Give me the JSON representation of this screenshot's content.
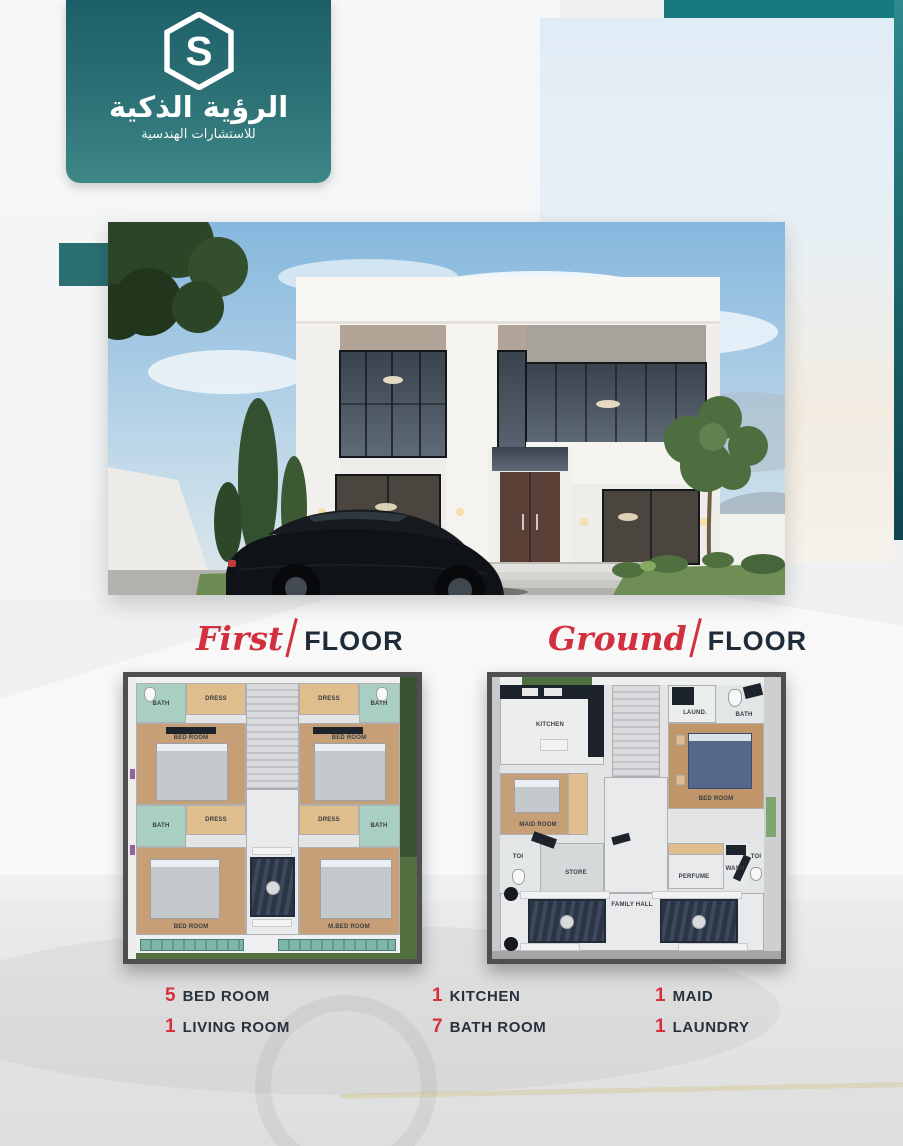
{
  "brand": {
    "title_ar": "الرؤية الذكية",
    "subtitle_ar": "للاستشارات الهندسية",
    "logo_letter": "S"
  },
  "sections": {
    "first": {
      "script": "First",
      "word": "FLOOR"
    },
    "ground": {
      "script": "Ground",
      "word": "FLOOR"
    }
  },
  "plans": {
    "first": {
      "rooms": [
        "DRESS",
        "BATH",
        "BED ROOM",
        "DRESS",
        "BATH",
        "BED ROOM",
        "DRESS",
        "BATH",
        "BED ROOM",
        "DRESS",
        "BATH",
        "M.BED ROOM"
      ]
    },
    "ground": {
      "rooms": [
        "KITCHEN",
        "LAUND.",
        "BATH",
        "BED ROOM",
        "MAID ROOM",
        "TOI",
        "STORE",
        "PERFUME",
        "WASH",
        "TOI",
        "FAMILY HALL"
      ]
    }
  },
  "stats": [
    {
      "count": "5",
      "label": "BED ROOM"
    },
    {
      "count": "1",
      "label": "LIVING ROOM"
    },
    {
      "count": "1",
      "label": "KITCHEN"
    },
    {
      "count": "7",
      "label": "BATH ROOM"
    },
    {
      "count": "1",
      "label": "MAID"
    },
    {
      "count": "1",
      "label": "LAUNDRY"
    }
  ],
  "colors": {
    "teal": "#266b71",
    "teal_dark": "#123f48",
    "red": "#d2303e",
    "navy": "#202d3a"
  }
}
